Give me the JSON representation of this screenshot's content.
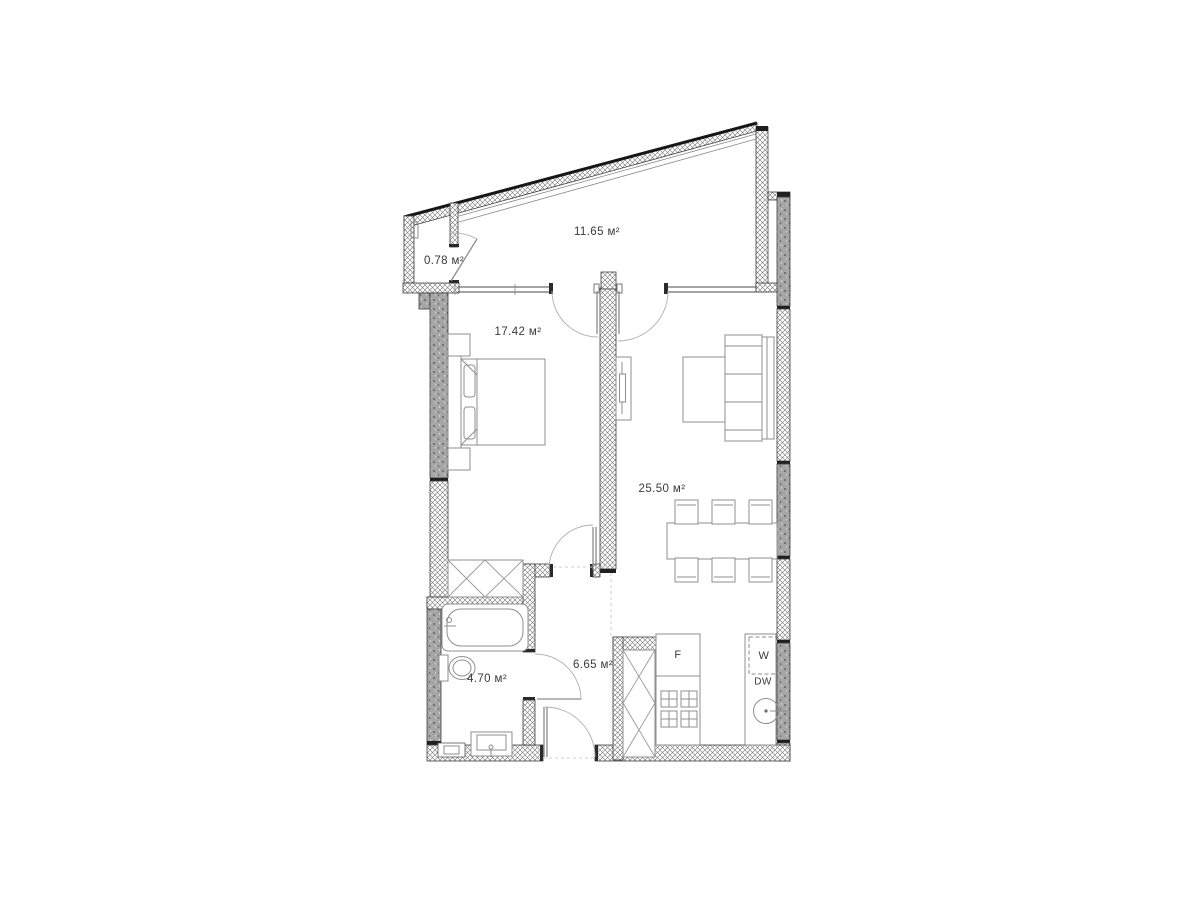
{
  "plan": {
    "type": "apartment-floor-plan",
    "area_unit": "м²",
    "rooms": {
      "balcony": {
        "name": "balcony",
        "area_label": "11.65 м²"
      },
      "storage": {
        "name": "storage",
        "area_label": "0.78 м²"
      },
      "bedroom": {
        "name": "bedroom",
        "area_label": "17.42 м²"
      },
      "living": {
        "name": "living-kitchen",
        "area_label": "25.50 м²"
      },
      "hallway": {
        "name": "hallway",
        "area_label": "6.65 м²"
      },
      "bathroom": {
        "name": "bathroom",
        "area_label": "4.70 м²"
      }
    },
    "appliances": {
      "fridge": "F",
      "washer": "W",
      "dishwasher": "DW"
    },
    "colors": {
      "paper": "#ffffff",
      "wall_line": "#3d3d3d",
      "concrete_fill": "#a6a6a6",
      "hatch_line": "#747474",
      "furniture_line": "#8f8f8f",
      "door_arc": "#b0b0b0",
      "label_text": "#3a3a3a"
    }
  }
}
